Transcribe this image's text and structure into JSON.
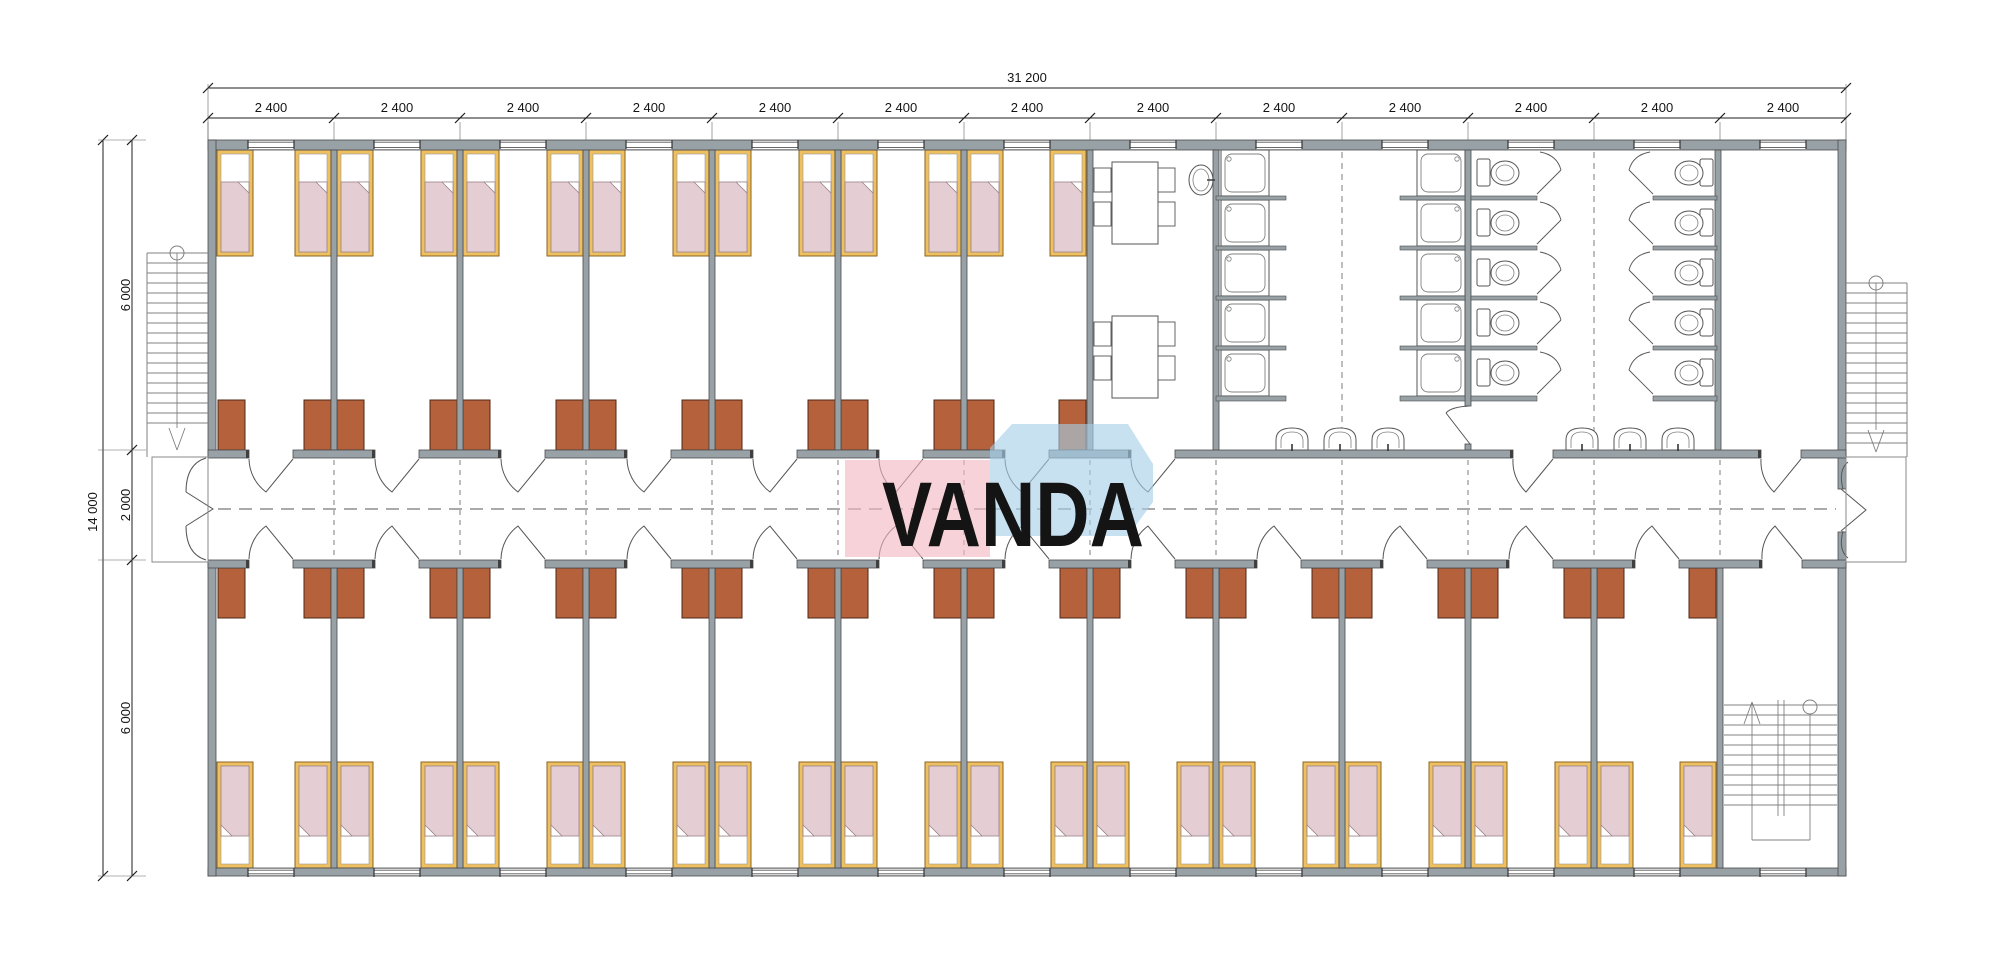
{
  "drawing": {
    "type": "architectural-floor-plan",
    "subject": "modular dormitory building floor plan"
  },
  "logo": {
    "text": "VANDA"
  },
  "dimensions": {
    "top_total": "31 200",
    "module": "2 400",
    "module_count": 13,
    "left_total": "14 000",
    "left_top": "6 000",
    "left_mid": "2 000",
    "left_bottom": "6 000"
  },
  "colors": {
    "wall": "#97a1a6",
    "wall_edge": "#4c4c4c",
    "jamb": "#3f3f3f",
    "bed_frame": "#efc05f",
    "bed_frame_edge": "#8a6426",
    "mattress": "#e4ced4",
    "mattress_edge": "#9a8288",
    "wardrobe": "#b4613c",
    "wardrobe_edge": "#502814",
    "fixture_line": "#555555",
    "fixture_line2": "#808080",
    "dash": "#6f6f6f",
    "dim": "#1c1c1c",
    "logo_pink": "#f4b6c2",
    "logo_blue": "#a6cee9",
    "logo_text": "#ffffff"
  },
  "counts": {
    "modules": 13,
    "bedrooms_top": 7,
    "bedrooms_bottom": 12,
    "beds": 38,
    "wardrobes": 38,
    "shower_stalls": 10,
    "toilet_stalls": 10,
    "wash_basins": 7,
    "dining_tables": 2,
    "dining_chairs": 8,
    "external_stairs": 2,
    "internal_stairs": 1
  }
}
